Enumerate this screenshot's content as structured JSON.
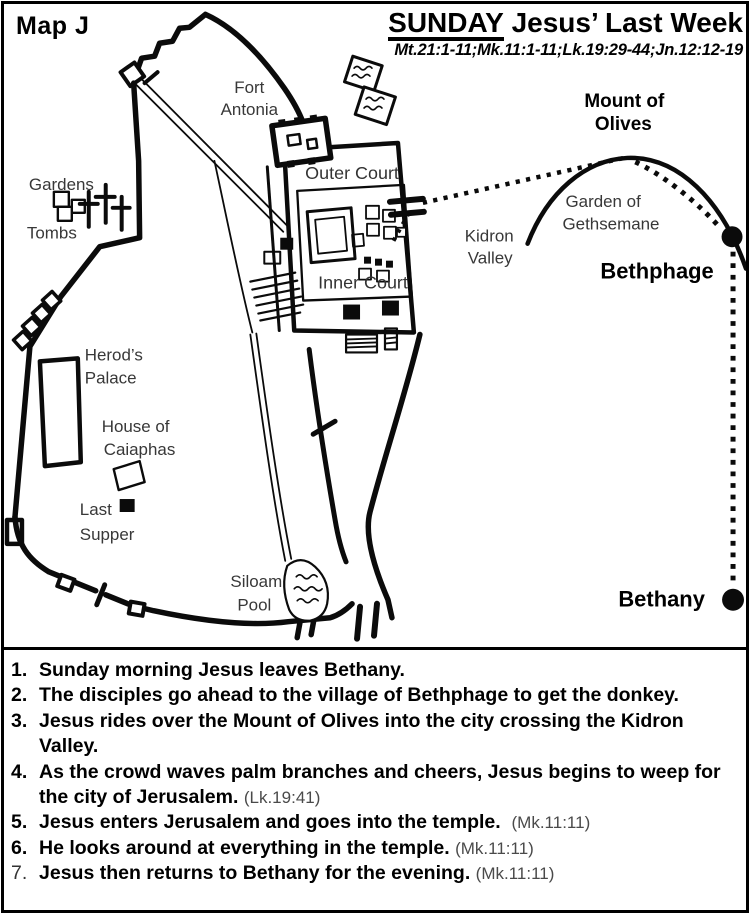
{
  "header": {
    "map_label": "Map J",
    "title_word": "SUNDAY",
    "title_rest": " Jesus’ Last Week",
    "references": "Mt.21:1-11;Mk.11:1-11;Lk.19:29-44;Jn.12:12-19"
  },
  "map": {
    "labels": {
      "fort_antonia": [
        "Fort",
        "Antonia"
      ],
      "outer_court": "Outer Court",
      "inner_court": "Inner Court",
      "gardens": "Gardens",
      "tombs": "Tombs",
      "herods_palace": [
        "Herod’s",
        "Palace"
      ],
      "house_of_caiaphas": [
        "House of",
        "Caiaphas"
      ],
      "last_supper": [
        "Last",
        "Supper"
      ],
      "siloam_pool": [
        "Siloam",
        "Pool"
      ],
      "kidron_valley": [
        "Kidron",
        "Valley"
      ],
      "garden_of_gethsemane": [
        "Garden of",
        "Gethsemane"
      ],
      "mount_of_olives": [
        "Mount of",
        "Olives"
      ],
      "bethphage": "Bethphage",
      "bethany": "Bethany"
    }
  },
  "events": {
    "items": [
      {
        "num": "1.",
        "text": "Sunday morning Jesus leaves Bethany.",
        "ref": ""
      },
      {
        "num": "2.",
        "text": "The disciples go ahead to the village of Bethphage to get the donkey.",
        "ref": ""
      },
      {
        "num": "3.",
        "text": "Jesus rides over the Mount of Olives into the city crossing the Kidron Valley.",
        "ref": ""
      },
      {
        "num": "4.",
        "text": "As the crowd waves palm branches and cheers, Jesus begins to weep for the city of Jerusalem.",
        "ref": "(Lk.19:41)"
      },
      {
        "num": "5.",
        "text": "Jesus enters Jerusalem and goes into the temple.",
        "ref": "(Mk.11:11)"
      },
      {
        "num": "6.",
        "text": "He looks around at everything in the temple.",
        "ref": "(Mk.11:11)"
      },
      {
        "num": "7.",
        "text": "Jesus then returns to Bethany for the evening.",
        "ref": "(Mk.11:11)"
      }
    ]
  },
  "colors": {
    "ink": "#0b0b0b",
    "label": "#383838",
    "reference": "#4a4a4a"
  }
}
